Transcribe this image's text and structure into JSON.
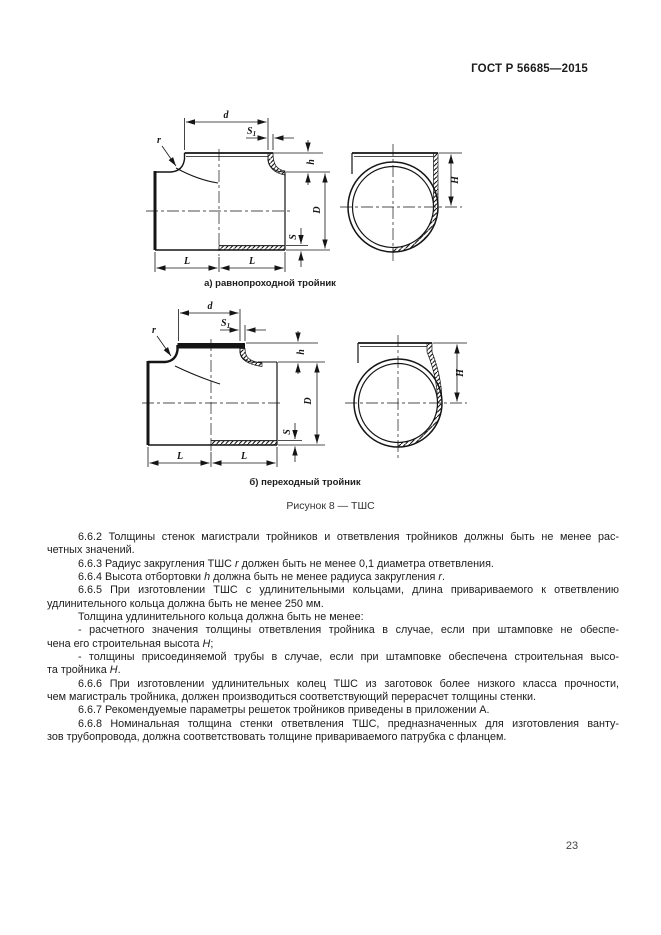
{
  "page": {
    "doc_number": "ГОСТ Р 56685—2015",
    "page_number": "23"
  },
  "figure": {
    "caption_a": "а) равнопроходной тройник",
    "caption_b": "б) переходный тройник",
    "caption": "Рисунок 8 — ТШС",
    "dim": {
      "d": "d",
      "s_base": "S",
      "s_sub": "1",
      "r": "r",
      "h": "h",
      "D": "D",
      "S": "S",
      "L": "L",
      "H": "H"
    }
  },
  "body": {
    "lines": [
      {
        "text": "6.6.2 Толщины стенок магистрали тройников и ответвления тройников должны быть не менее рас-",
        "indent": true,
        "fill": true
      },
      {
        "text": "четных значений.",
        "indent": false,
        "fill": false
      },
      {
        "text": "6.6.3 Радиус закругления ТШС *r* должен быть не менее 0,1 диаметра ответвления.",
        "indent": true,
        "fill": false
      },
      {
        "text": "6.6.4 Высота отбортовки *h* должна быть не менее радиуса закругления *r*.",
        "indent": true,
        "fill": false
      },
      {
        "text": "6.6.5 При изготовлении ТШС с удлинительными кольцами, длина привариваемого к ответвлению",
        "indent": true,
        "fill": true
      },
      {
        "text": "удлинительного кольца должна быть не менее 250 мм.",
        "indent": false,
        "fill": false
      },
      {
        "text": "Толщина удлинительного кольца должна быть не менее:",
        "indent": true,
        "fill": false
      },
      {
        "text": "- расчетного значения толщины ответвления тройника в случае, если при штамповке не обеспе-",
        "indent": true,
        "fill": true
      },
      {
        "text": "чена его строительная высота *H*;",
        "indent": false,
        "fill": false
      },
      {
        "text": "- толщины присоединяемой трубы в случае, если при штамповке обеспечена строительная высо-",
        "indent": true,
        "fill": true
      },
      {
        "text": "та тройника *H*.",
        "indent": false,
        "fill": false
      },
      {
        "text": "6.6.6 При изготовлении удлинительных колец ТШС из заготовок более низкого класса прочности,",
        "indent": true,
        "fill": true
      },
      {
        "text": "чем магистраль тройника, должен производиться соответствующий перерасчет толщины стенки.",
        "indent": false,
        "fill": false
      },
      {
        "text": "6.6.7 Рекомендуемые параметры решеток тройников приведены в приложении А.",
        "indent": true,
        "fill": false
      },
      {
        "text": "6.6.8 Номинальная толщина стенки ответвления ТШС, предназначенных для изготовления ванту-",
        "indent": true,
        "fill": true
      },
      {
        "text": "зов трубопровода, должна соответствовать толщине привариваемого патрубка с фланцем.",
        "indent": false,
        "fill": false
      }
    ]
  }
}
